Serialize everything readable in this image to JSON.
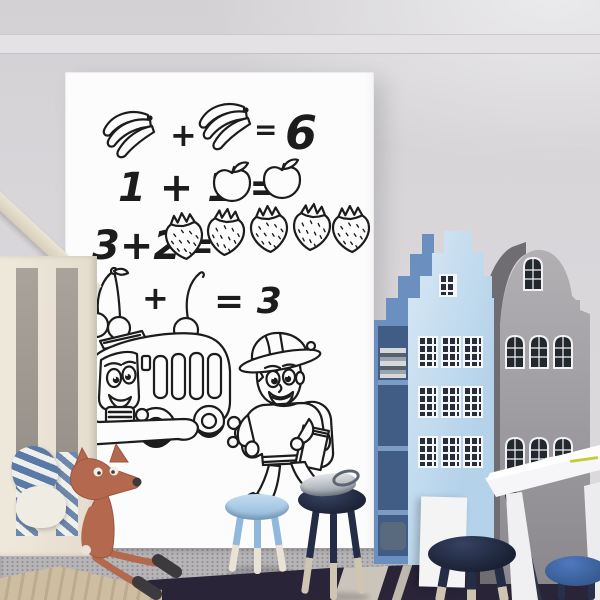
{
  "board": {
    "eq1": {
      "op": "+",
      "eq": "=",
      "result": "6"
    },
    "eq2": {
      "lhs": "1 + 1 ="
    },
    "eq3": {
      "lhs": "3+2="
    },
    "eq4": {
      "op": "+",
      "eq": "= 3"
    }
  },
  "board_icons": {
    "eq1_operands": [
      "banana-bunch",
      "banana-bunch"
    ],
    "eq2_result": [
      "apple",
      "apple"
    ],
    "eq3_result": [
      "strawberry",
      "strawberry",
      "strawberry",
      "strawberry",
      "strawberry"
    ],
    "eq4_operands": [
      "cherry-pair",
      "cherry-single"
    ],
    "drawings": [
      "cartoon-school-bus",
      "cartoon-schoolboy-with-backpack-and-book"
    ]
  },
  "scene_objects": [
    "whiteboard-wall-sticker",
    "house-frame-bed",
    "plush-fox-toy",
    "dark-blue-house-shelf",
    "light-blue-house-wardrobe",
    "gray-house-wardrobe",
    "white-desk",
    "light-blue-stool",
    "navy-stool-with-toy",
    "navy-stool",
    "blue-corner-stool",
    "gray-carpet",
    "navy-rug",
    "tan-rug"
  ],
  "colors": {
    "wall": "#d8d6d9",
    "board": "#fcfcfd",
    "ink": "#1c1c1c",
    "house_light_blue": "#b8d4ea",
    "house_dark_blue": "#6b90bf",
    "house_gray": "#a5a3a6",
    "stool_navy": "#232b44",
    "stool_blue": "#a9cce9",
    "fox": "#b4694e",
    "desk": "#f6f6f8",
    "carpet": "#b6b4b6",
    "rug_navy": "#2a2438",
    "rug_tan": "#cdbea2",
    "bed_frame": "#ece5d7"
  }
}
